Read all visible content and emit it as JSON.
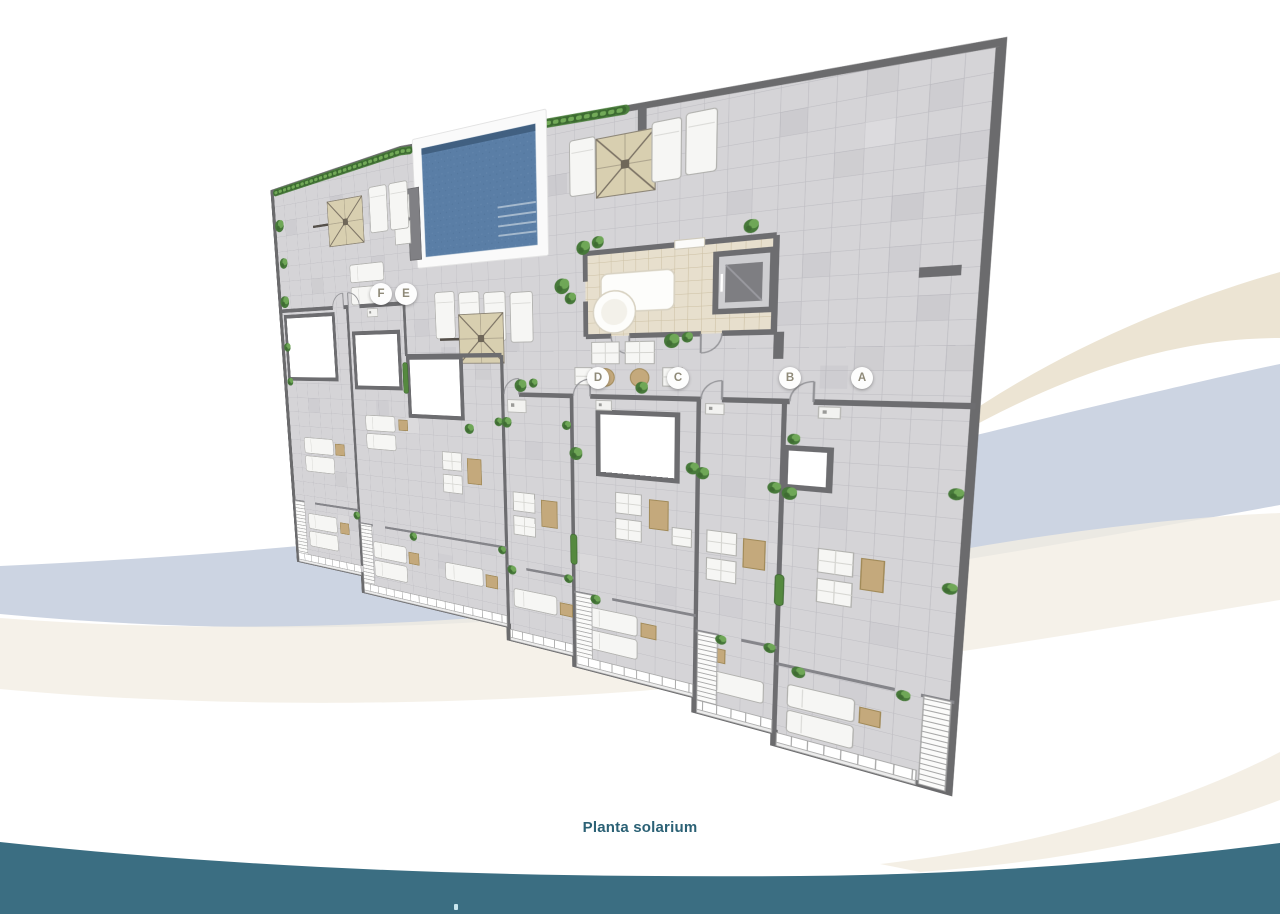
{
  "caption": {
    "text": "Planta solarium"
  },
  "plan": {
    "unit_markers": [
      "F",
      "E",
      "D",
      "C",
      "B",
      "A"
    ]
  },
  "palette": {
    "teal_wave": "#3b6e82",
    "caption_text": "#2b6175",
    "marker_letter": "#8f8a79",
    "swoosh_blue": "#ccd4e2",
    "swoosh_cream": "#ece4d3",
    "swoosh_warm": "#f3eee3",
    "pool_water": "#5a7ea6",
    "parasol_canopy": "#d8cfb0",
    "bar_floor": "#e7dfcd",
    "plant_green": "#47793a",
    "wall_gray": "#6d6d70",
    "tile_gray": "#d5d4d7",
    "wood_tan": "#c4a97c"
  }
}
